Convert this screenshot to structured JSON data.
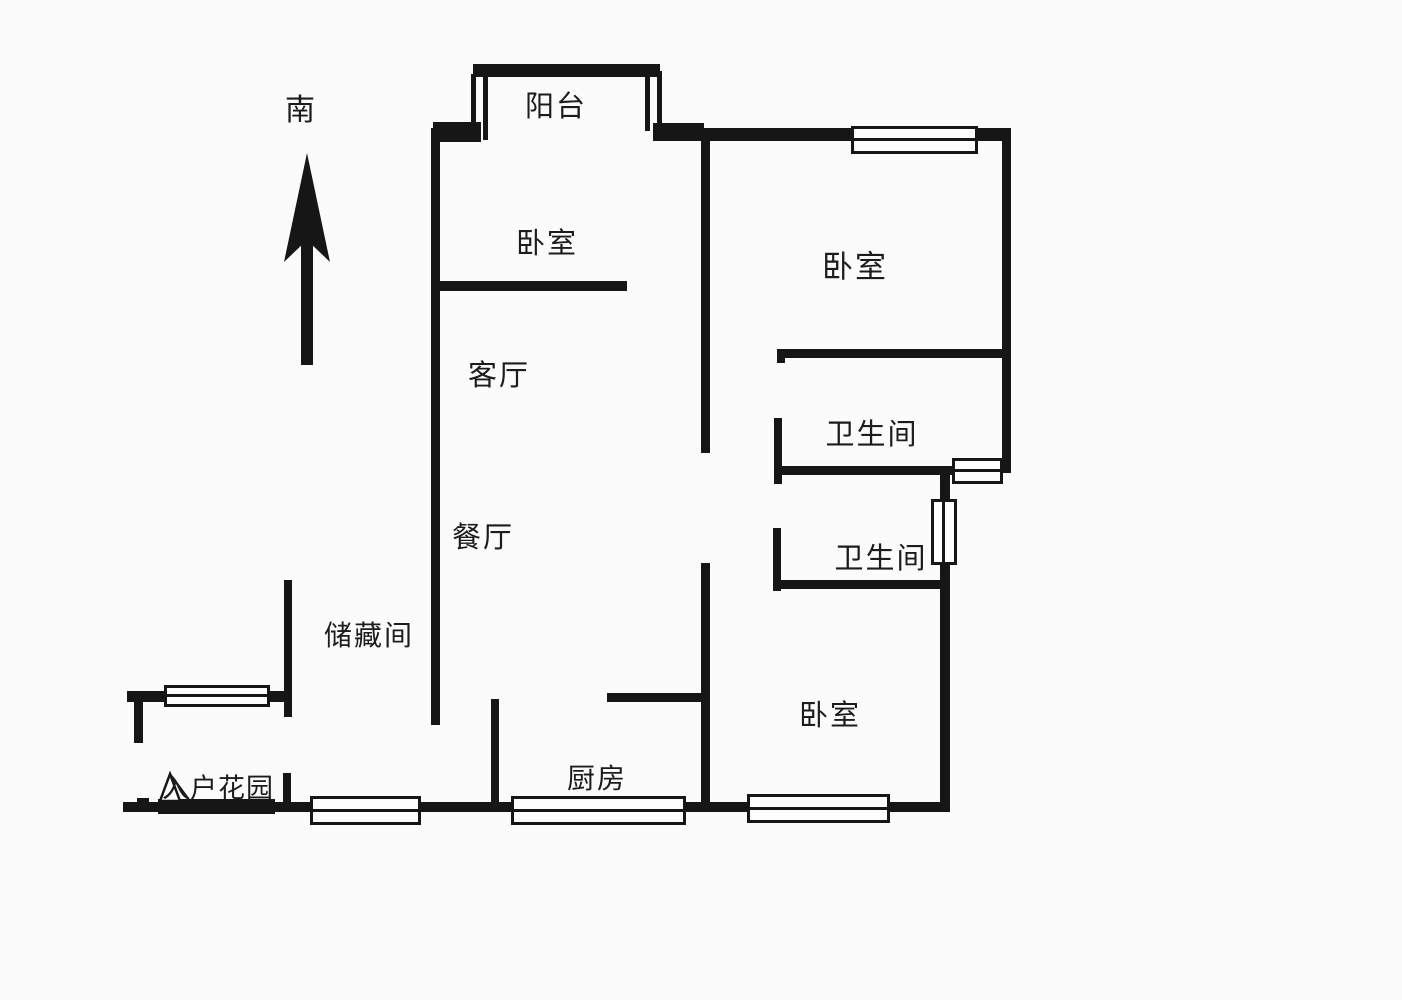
{
  "colors": {
    "wall": "#161616",
    "background": "#fbfbfb",
    "text": "#1c1c1c",
    "window_fill": "#fdfdfd"
  },
  "compass": {
    "label": "南"
  },
  "labels": {
    "balcony": {
      "text": "阳台"
    },
    "bedroom_top_left": {
      "text": "卧室"
    },
    "bedroom_top_right": {
      "text": "卧室"
    },
    "living_room": {
      "text": "客厅"
    },
    "dining_room": {
      "text": "餐厅"
    },
    "bathroom_upper": {
      "text": "卫生间"
    },
    "bathroom_lower": {
      "text": "卫生间"
    },
    "storage_room": {
      "text": "储藏间"
    },
    "entry_garden": {
      "text": "入户花园"
    },
    "kitchen": {
      "text": "厨房"
    },
    "bedroom_bottom": {
      "text": "卧室"
    }
  },
  "floorplan": {
    "walls": [
      {
        "id": "balcony-top",
        "x": 473,
        "y": 64,
        "w": 187,
        "h": 13
      },
      {
        "id": "balcony-left-outer",
        "x": 471,
        "y": 74,
        "w": 5,
        "h": 66
      },
      {
        "id": "balcony-left-inner",
        "x": 483,
        "y": 74,
        "w": 5,
        "h": 66
      },
      {
        "id": "balcony-right-inner",
        "x": 645,
        "y": 71,
        "w": 5,
        "h": 60
      },
      {
        "id": "balcony-right-outer",
        "x": 657,
        "y": 71,
        "w": 5,
        "h": 60
      },
      {
        "id": "top-wall-left",
        "x": 433,
        "y": 122,
        "w": 48,
        "h": 20
      },
      {
        "id": "top-wall-mid",
        "x": 653,
        "y": 123,
        "w": 51,
        "h": 18
      },
      {
        "id": "top-wall-right",
        "x": 700,
        "y": 128,
        "w": 311,
        "h": 13
      },
      {
        "id": "right-wall-upper",
        "x": 1002,
        "y": 128,
        "w": 9,
        "h": 345
      },
      {
        "id": "right-wall-lower",
        "x": 940,
        "y": 467,
        "w": 10,
        "h": 345
      },
      {
        "id": "bottom-wall",
        "x": 123,
        "y": 802,
        "w": 825,
        "h": 10
      },
      {
        "id": "left-wall-main",
        "x": 431,
        "y": 128,
        "w": 9,
        "h": 597
      },
      {
        "id": "storage-left-wall",
        "x": 284,
        "y": 580,
        "w": 8,
        "h": 137
      },
      {
        "id": "entrance-top-wall",
        "x": 127,
        "y": 691,
        "w": 163,
        "h": 11
      },
      {
        "id": "entrance-left-stub",
        "x": 134,
        "y": 697,
        "w": 9,
        "h": 46
      },
      {
        "id": "entrance-right-stub",
        "x": 283,
        "y": 773,
        "w": 8,
        "h": 37
      },
      {
        "id": "entry-door-bar",
        "x": 158,
        "y": 799,
        "w": 117,
        "h": 15
      },
      {
        "id": "bottom-left-tick",
        "x": 137,
        "y": 798,
        "w": 12,
        "h": 6
      },
      {
        "id": "bedroom1-divider",
        "x": 435,
        "y": 281,
        "w": 192,
        "h": 10
      },
      {
        "id": "central-wall-upper",
        "x": 701,
        "y": 137,
        "w": 9,
        "h": 316
      },
      {
        "id": "central-wall-lower",
        "x": 701,
        "y": 563,
        "w": 9,
        "h": 247
      },
      {
        "id": "bedroom2-partial",
        "x": 779,
        "y": 349,
        "w": 230,
        "h": 9
      },
      {
        "id": "bedroom2-partial-tick",
        "x": 777,
        "y": 349,
        "w": 8,
        "h": 14
      },
      {
        "id": "bath1-stub",
        "x": 774,
        "y": 418,
        "w": 8,
        "h": 66
      },
      {
        "id": "bath1-wall",
        "x": 779,
        "y": 466,
        "w": 176,
        "h": 9
      },
      {
        "id": "bath2-stub",
        "x": 773,
        "y": 528,
        "w": 8,
        "h": 63
      },
      {
        "id": "bath2-wall",
        "x": 779,
        "y": 580,
        "w": 164,
        "h": 9
      },
      {
        "id": "kitchen-top-wall",
        "x": 607,
        "y": 693,
        "w": 100,
        "h": 9
      },
      {
        "id": "kitchen-left-wall",
        "x": 491,
        "y": 699,
        "w": 8,
        "h": 110
      }
    ],
    "windows": [
      {
        "id": "bedroom1-top-window",
        "x": 851,
        "y": 126,
        "w": 127,
        "h": 28,
        "o": "h"
      },
      {
        "id": "right-step-window",
        "x": 952,
        "y": 458,
        "w": 51,
        "h": 26,
        "o": "h"
      },
      {
        "id": "bath-side-window",
        "x": 931,
        "y": 499,
        "w": 26,
        "h": 66,
        "o": "v"
      },
      {
        "id": "entrance-side-window",
        "x": 164,
        "y": 685,
        "w": 106,
        "h": 22,
        "o": "h"
      },
      {
        "id": "entrance-bottom-window",
        "x": 310,
        "y": 796,
        "w": 111,
        "h": 29,
        "o": "h"
      },
      {
        "id": "kitchen-window",
        "x": 511,
        "y": 796,
        "w": 175,
        "h": 29,
        "o": "h"
      },
      {
        "id": "bedroom3-window",
        "x": 747,
        "y": 794,
        "w": 143,
        "h": 29,
        "o": "h"
      }
    ]
  }
}
